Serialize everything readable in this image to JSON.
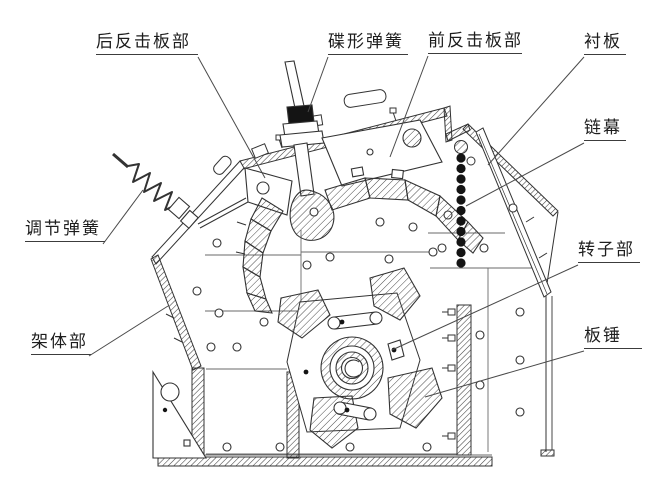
{
  "figure": {
    "kind": "technical line diagram",
    "subject_labels_language": "Chinese"
  },
  "labels": {
    "rear_impact_plate": {
      "text": "后反击板部"
    },
    "disc_spring": {
      "text": "碟形弹簧"
    },
    "front_impact_plate": {
      "text": "前反击板部"
    },
    "liner_plate": {
      "text": "衬板"
    },
    "chain_curtain": {
      "text": "链幕"
    },
    "rotor": {
      "text": "转子部"
    },
    "plate_hammer": {
      "text": "板锤"
    },
    "adjusting_spring": {
      "text": "调节弹簧"
    },
    "frame": {
      "text": "架体部"
    }
  },
  "colors": {
    "background": "#ffffff",
    "line": "#3a3a3a",
    "hatch": "#4a4a4a",
    "solid_fill": "#141414",
    "label_text": "#1d1d1d"
  }
}
